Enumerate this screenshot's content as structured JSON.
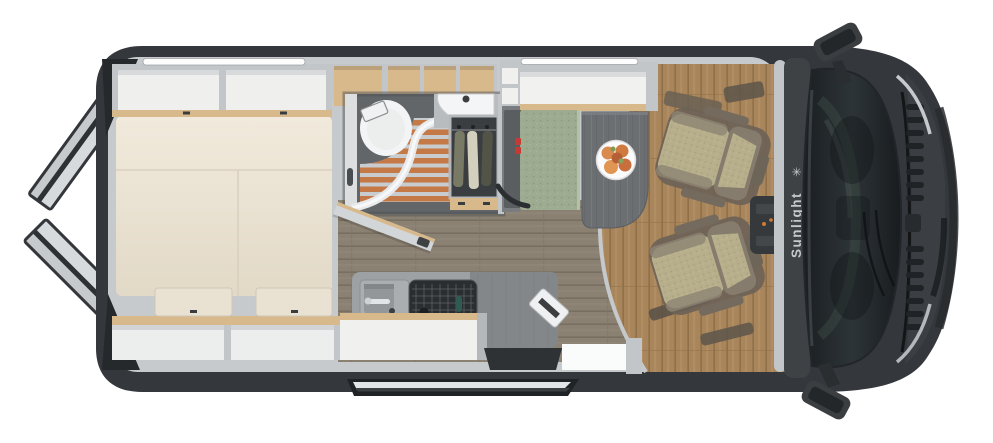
{
  "brand": {
    "label": "Sunlight",
    "logo_glyph": "✳"
  },
  "colors": {
    "body": "#34373b",
    "wall": "#c7cacc",
    "wood_trim": "#d8b98c",
    "mattress": "#ece4d4",
    "floor_living": "#8b8173",
    "floor_cab": "#a8855b",
    "shower_slats": "#c57947",
    "bench_green": "#9dab90",
    "table": "#6b6f72",
    "seat_tan": "#b7ae8b",
    "seat_frame": "#6e6559",
    "windshield": "#22262a",
    "step_silver": "#e3e6e8",
    "buckle_red": "#c23b35",
    "led": "#fdfdfd",
    "plate": "#fbfbfb",
    "fruit": "#d98a4e",
    "wardrobe": "#3b3e40"
  }
}
